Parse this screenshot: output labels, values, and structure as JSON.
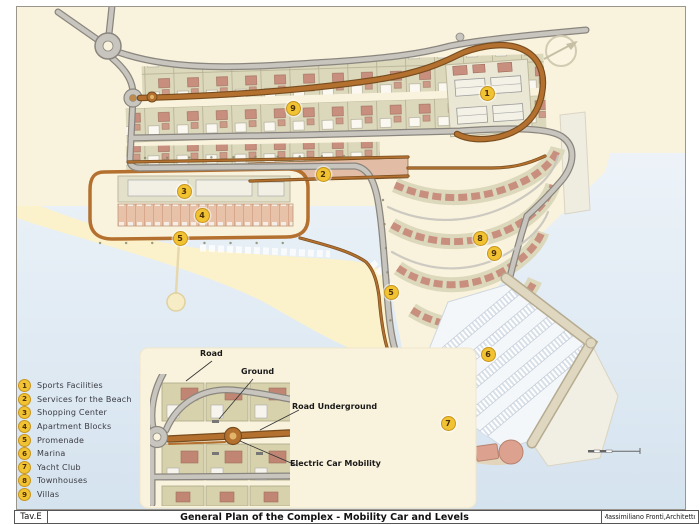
{
  "title_bar": {
    "sheet": "Tav.E",
    "title": "General Plan of the Complex - Mobility Car and Levels",
    "author": "Massimiliano Fronti,Architetto"
  },
  "legend": {
    "items": [
      {
        "num": "1",
        "label": "Sports Facilities"
      },
      {
        "num": "2",
        "label": "Services for the Beach"
      },
      {
        "num": "3",
        "label": "Shopping Center"
      },
      {
        "num": "4",
        "label": "Apartment Blocks"
      },
      {
        "num": "5",
        "label": "Promenade"
      },
      {
        "num": "6",
        "label": "Marina"
      },
      {
        "num": "7",
        "label": "Yacht Club"
      },
      {
        "num": "8",
        "label": "Townhouses"
      },
      {
        "num": "9",
        "label": "Villas"
      }
    ]
  },
  "map": {
    "markers": [
      {
        "num": "1",
        "x": 486,
        "y": 92
      },
      {
        "num": "2",
        "x": 322,
        "y": 173
      },
      {
        "num": "3",
        "x": 183,
        "y": 190
      },
      {
        "num": "4",
        "x": 201,
        "y": 214
      },
      {
        "num": "5",
        "x": 179,
        "y": 237
      },
      {
        "num": "5",
        "x": 390,
        "y": 291
      },
      {
        "num": "6",
        "x": 487,
        "y": 353
      },
      {
        "num": "7",
        "x": 447,
        "y": 422
      },
      {
        "num": "8",
        "x": 479,
        "y": 237
      },
      {
        "num": "9",
        "x": 292,
        "y": 107
      },
      {
        "num": "9",
        "x": 493,
        "y": 252
      }
    ],
    "labels": {
      "road": "Road",
      "ground": "Ground",
      "road_underground": "Road Underground",
      "electric_car": "Electric Car Mobility"
    },
    "icons": {
      "compass": "north-arrow-compass-icon",
      "scale_bar": "graphic-scale-bar"
    }
  },
  "colors": {
    "land": "#F9F2DC",
    "beach": "#FBF2CC",
    "sea_top": "#F6F9FC",
    "sea_bottom": "#D5E3EF",
    "road_fill": "#C8C5BF",
    "road_edge": "#8A867F",
    "underground_fill": "#B4702E",
    "underground_edge": "#774D1F",
    "lot": "#DCD8BC",
    "lot_edge": "#B6B094",
    "house_red": "#C98F7E",
    "services": "#E2BCA4",
    "shopping": "#E3E1C9",
    "apartments": "#E7C2A9",
    "marina_water": "#F4F7FA",
    "pier_edge": "#C2CBD6",
    "breakwater": "#E0D7C0",
    "breakwater_edge": "#B5AB90",
    "yacht": "#DCA28F",
    "yacht_edge": "#B6826F",
    "marker_fill": "#F1C232",
    "marker_edge": "#C7951E",
    "marker_text": "#4A2F08"
  }
}
